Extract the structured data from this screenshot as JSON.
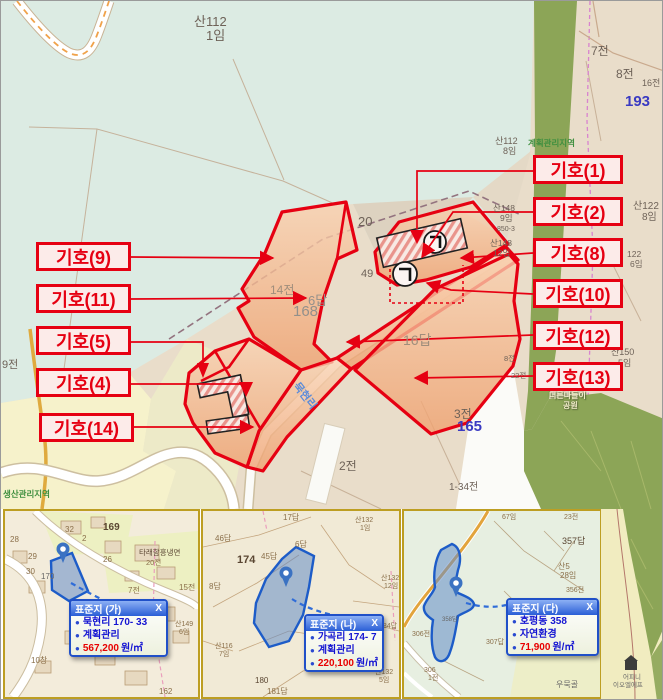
{
  "callouts": {
    "left": [
      "기호(9)",
      "기호(11)",
      "기호(5)",
      "기호(4)",
      "기호(14)"
    ],
    "right": [
      "기호(1)",
      "기호(2)",
      "기호(8)",
      "기호(10)",
      "기호(12)",
      "기호(13)"
    ]
  },
  "map": {
    "labels": {
      "san112": "산112",
      "san112_lot": "1임",
      "jeon7": "7전",
      "jeon8": "8전",
      "jeon16": "16전",
      "lot193": "193",
      "zone_plan": "계획관리지역",
      "san112b": "산112",
      "san112b_lot": "8임",
      "san122": "산122",
      "san122_lot": "8임",
      "lot122": "122",
      "lot122_lot": "6임",
      "san148a": "산148",
      "san148a_lot": "9임",
      "lot850": "850-3",
      "san148b": "산148",
      "san148b_lot": "12임",
      "num20": "20",
      "num49": "49",
      "jeon14": "14전",
      "dap6": "6답",
      "lot168": "168",
      "dap16": "16답",
      "jeon3": "3전",
      "lot165": "165",
      "jeon2": "2전",
      "jeon134": "1-34전",
      "jeon9": "9전",
      "zone_prod": "생산관리지역",
      "san150": "산150",
      "san150_lot": "5임",
      "jeon8b": "8전",
      "jeon22": "22전",
      "park1": "너른나들이",
      "park2": "공원",
      "road": "묵현리"
    }
  },
  "panels": {
    "ga": {
      "title": "표준지 (가)",
      "close": "X",
      "addr": "묵현리 170- 33",
      "zone": "계획관리",
      "price": "567,200",
      "unit": "원/㎡",
      "labels": {
        "l169": "169",
        "l32": "32",
        "l2": "2",
        "l28": "28",
        "l29": "29",
        "l30": "30",
        "l26": "26",
        "l170": "170",
        "shop": "타래함흥냉면",
        "j20": "20전",
        "j7": "7전",
        "j15": "15전",
        "san149": "산149",
        "san149_lot": "6임",
        "l162": "162",
        "l10": "10창"
      }
    },
    "na": {
      "title": "표준지 (나)",
      "close": "X",
      "addr": "가곡리 174- 7",
      "zone": "계획관리",
      "price": "220,100",
      "unit": "원/㎡",
      "labels": {
        "d17": "17답",
        "san132a": "산132",
        "san132a_lot": "1임",
        "d46": "46답",
        "l174": "174",
        "d45": "45답",
        "d6": "6답",
        "d8": "8답",
        "san132b": "산132",
        "san132b_lot": "12임",
        "d184": "184답",
        "san116": "산116",
        "san116_lot": "7임",
        "l180": "180",
        "d181": "181답",
        "san132c": "산132",
        "san132c_lot": "5임"
      }
    },
    "da": {
      "title": "표준지 (다)",
      "close": "X",
      "addr": "호평동 358",
      "zone": "자연환경",
      "price": "71,900",
      "unit": "원/㎡",
      "labels": {
        "i67": "67임",
        "j23": "23전",
        "d357": "357답",
        "san5": "산5",
        "san5_lot": "28임",
        "j356": "356전",
        "j306": "306전",
        "d307": "307답",
        "l306": "306",
        "l306_lot": "1전",
        "vill": "우묵골",
        "d358": "358답"
      }
    }
  },
  "side": {
    "bldg1": "어피니",
    "bldg2": "이오엘에프"
  }
}
